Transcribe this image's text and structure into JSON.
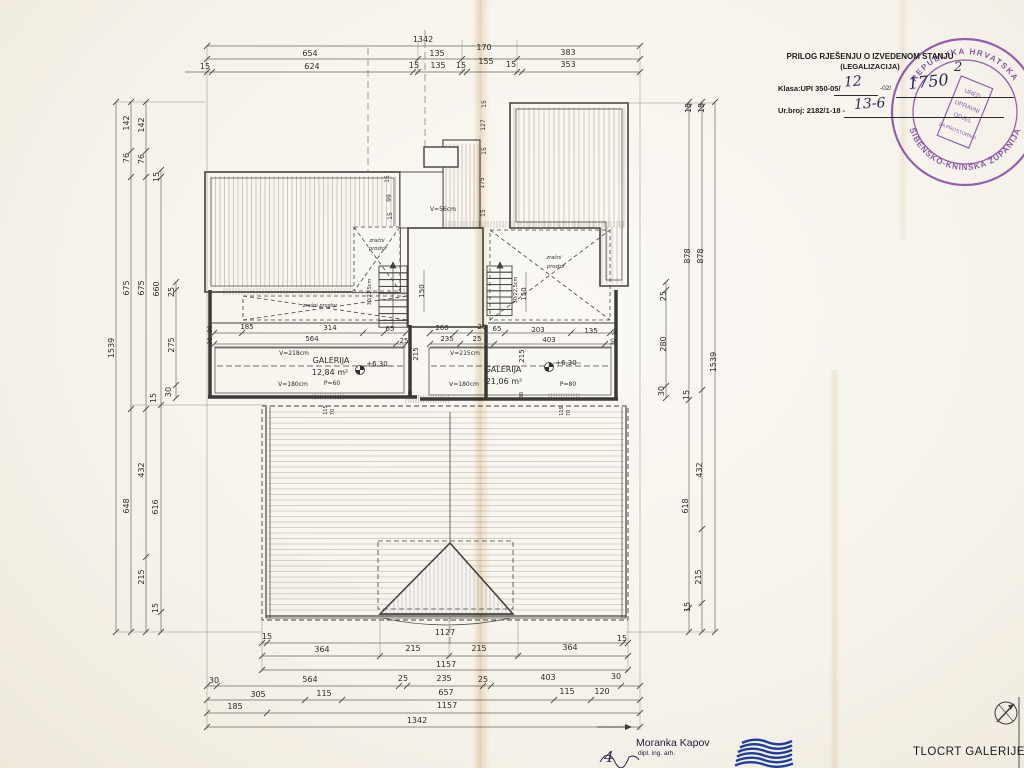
{
  "legalization_note": {
    "title": "PRILOG RJEŠENJU O IZVEDENOM STANJU",
    "subtitle": "(LEGALIZACIJA)",
    "klasa_label": "Klasa:UPI 350-05/",
    "klasa_value1": "12",
    "klasa_suffix": "-02/",
    "klasa_value2": "1750",
    "urbroj_label": "Ur.broj: 2182/1-18 -",
    "urbroj_value": "13-6",
    "page_number": "2"
  },
  "seal": {
    "ring_top": "REPUBLIKA HRVATSKA",
    "ring_bottom": "ŠIBENSKO-KNINSKA ŽUPANIJA",
    "inner_line1": "URED",
    "inner_line2": "UPRAVNI",
    "inner_line3": "ODJEL",
    "inner_line4": "ZA PROSTORNO",
    "color": "#7d3f9e"
  },
  "footer": {
    "author_name": "Moranka Kapov",
    "author_title": "dipl. ing. arh.",
    "sheet_number": "4",
    "drawing_title": "TLOCRT GALERIJE"
  },
  "plan": {
    "rooms": [
      {
        "name": "GALERIJA",
        "area": "12,84 m²",
        "level": "+6,30",
        "height_top": "V=218cm",
        "height_bottom": "V=180cm",
        "parapet": "P=60"
      },
      {
        "name": "GALERIJA",
        "area": "21,06 m²",
        "level": "+6,30",
        "height_top": "V=215cm",
        "height_bottom": "V=180cm",
        "parapet": "P=80"
      }
    ],
    "labels": [
      {
        "t": "1342",
        "x": 423,
        "y": 42
      },
      {
        "t": "654",
        "x": 310,
        "y": 56
      },
      {
        "t": "135",
        "x": 437,
        "y": 56
      },
      {
        "t": "170",
        "x": 484,
        "y": 50
      },
      {
        "t": "383",
        "x": 568,
        "y": 55
      },
      {
        "t": "15",
        "x": 205,
        "y": 69
      },
      {
        "t": "624",
        "x": 312,
        "y": 69
      },
      {
        "t": "15",
        "x": 414,
        "y": 68
      },
      {
        "t": "135",
        "x": 438,
        "y": 68
      },
      {
        "t": "15",
        "x": 461,
        "y": 68
      },
      {
        "t": "155",
        "x": 486,
        "y": 64
      },
      {
        "t": "15",
        "x": 511,
        "y": 67
      },
      {
        "t": "353",
        "x": 568,
        "y": 67
      },
      {
        "t": "1539",
        "x": 114,
        "y": 348,
        "r": -90
      },
      {
        "t": "142",
        "x": 129,
        "y": 123,
        "r": -90
      },
      {
        "t": "142",
        "x": 144,
        "y": 125,
        "r": -90
      },
      {
        "t": "76",
        "x": 129,
        "y": 158,
        "r": -90
      },
      {
        "t": "76",
        "x": 144,
        "y": 159,
        "r": -90
      },
      {
        "t": "15",
        "x": 159,
        "y": 177,
        "r": -90
      },
      {
        "t": "675",
        "x": 129,
        "y": 288,
        "r": -90
      },
      {
        "t": "675",
        "x": 144,
        "y": 288,
        "r": -90
      },
      {
        "t": "660",
        "x": 159,
        "y": 289,
        "r": -90
      },
      {
        "t": "25",
        "x": 174,
        "y": 292,
        "r": -90
      },
      {
        "t": "275",
        "x": 174,
        "y": 345,
        "r": -90
      },
      {
        "t": "30",
        "x": 171,
        "y": 392,
        "r": -90
      },
      {
        "t": "15",
        "x": 156,
        "y": 398,
        "r": -90
      },
      {
        "t": "648",
        "x": 129,
        "y": 506,
        "r": -90
      },
      {
        "t": "432",
        "x": 144,
        "y": 470,
        "r": -90
      },
      {
        "t": "616",
        "x": 158,
        "y": 507,
        "r": -90
      },
      {
        "t": "215",
        "x": 144,
        "y": 577,
        "r": -90
      },
      {
        "t": "15",
        "x": 158,
        "y": 608,
        "r": -90
      },
      {
        "t": "1539",
        "x": 716,
        "y": 362,
        "r": -90
      },
      {
        "t": "15",
        "x": 691,
        "y": 108,
        "r": -90
      },
      {
        "t": "15",
        "x": 704,
        "y": 108,
        "r": -90
      },
      {
        "t": "878",
        "x": 690,
        "y": 256,
        "r": -90
      },
      {
        "t": "878",
        "x": 703,
        "y": 256,
        "r": -90
      },
      {
        "t": "25",
        "x": 666,
        "y": 296,
        "r": -90
      },
      {
        "t": "280",
        "x": 666,
        "y": 344,
        "r": -90
      },
      {
        "t": "30",
        "x": 664,
        "y": 391,
        "r": -90
      },
      {
        "t": "15",
        "x": 689,
        "y": 395,
        "r": -90
      },
      {
        "t": "618",
        "x": 688,
        "y": 506,
        "r": -90
      },
      {
        "t": "432",
        "x": 702,
        "y": 470,
        "r": -90
      },
      {
        "t": "215",
        "x": 701,
        "y": 577,
        "r": -90
      },
      {
        "t": "15",
        "x": 690,
        "y": 607,
        "r": -90
      },
      {
        "t": "15",
        "x": 267,
        "y": 639
      },
      {
        "t": "1127",
        "x": 445,
        "y": 635
      },
      {
        "t": "15",
        "x": 622,
        "y": 641
      },
      {
        "t": "364",
        "x": 322,
        "y": 652
      },
      {
        "t": "215",
        "x": 413,
        "y": 651
      },
      {
        "t": "215",
        "x": 479,
        "y": 651
      },
      {
        "t": "364",
        "x": 570,
        "y": 650
      },
      {
        "t": "1157",
        "x": 446,
        "y": 667
      },
      {
        "t": "30",
        "x": 214,
        "y": 683
      },
      {
        "t": "564",
        "x": 310,
        "y": 682
      },
      {
        "t": "25",
        "x": 403,
        "y": 681
      },
      {
        "t": "235",
        "x": 444,
        "y": 681
      },
      {
        "t": "25",
        "x": 483,
        "y": 682
      },
      {
        "t": "403",
        "x": 548,
        "y": 680
      },
      {
        "t": "30",
        "x": 616,
        "y": 679
      },
      {
        "t": "305",
        "x": 258,
        "y": 697
      },
      {
        "t": "115",
        "x": 324,
        "y": 696
      },
      {
        "t": "657",
        "x": 446,
        "y": 695
      },
      {
        "t": "115",
        "x": 567,
        "y": 694
      },
      {
        "t": "120",
        "x": 602,
        "y": 694
      },
      {
        "t": "185",
        "x": 235,
        "y": 709
      },
      {
        "t": "1157",
        "x": 447,
        "y": 708
      },
      {
        "t": "1342",
        "x": 417,
        "y": 723
      },
      {
        "t": "30",
        "x": 212,
        "y": 329,
        "r": -90,
        "s": 6
      },
      {
        "t": "185",
        "x": 247,
        "y": 329,
        "s": 7
      },
      {
        "t": "314",
        "x": 330,
        "y": 330,
        "s": 7
      },
      {
        "t": "65",
        "x": 390,
        "y": 331,
        "s": 7
      },
      {
        "t": "30",
        "x": 212,
        "y": 341,
        "r": -90,
        "s": 6
      },
      {
        "t": "564",
        "x": 312,
        "y": 341,
        "s": 7
      },
      {
        "t": "25",
        "x": 404,
        "y": 343,
        "s": 7
      },
      {
        "t": "260",
        "x": 442,
        "y": 330,
        "s": 7
      },
      {
        "t": "25",
        "x": 482,
        "y": 329,
        "s": 7
      },
      {
        "t": "65",
        "x": 497,
        "y": 331,
        "s": 7
      },
      {
        "t": "203",
        "x": 538,
        "y": 332,
        "s": 7
      },
      {
        "t": "135",
        "x": 591,
        "y": 333,
        "s": 7
      },
      {
        "t": "30",
        "x": 617,
        "y": 332,
        "r": -90,
        "s": 6
      },
      {
        "t": "235",
        "x": 447,
        "y": 341,
        "s": 7
      },
      {
        "t": "25",
        "x": 477,
        "y": 341,
        "s": 7
      },
      {
        "t": "403",
        "x": 549,
        "y": 342,
        "s": 7
      },
      {
        "t": "30",
        "x": 615,
        "y": 342,
        "r": -90,
        "s": 6
      },
      {
        "t": "215",
        "x": 418,
        "y": 354,
        "r": -90,
        "s": 7
      },
      {
        "t": "215",
        "x": 524,
        "y": 356,
        "r": -90,
        "s": 7
      },
      {
        "t": "150",
        "x": 424,
        "y": 291,
        "r": -90,
        "s": 7
      },
      {
        "t": "150",
        "x": 526,
        "y": 294,
        "r": -90,
        "s": 7
      },
      {
        "t": "30/22,5cm",
        "x": 371,
        "y": 292,
        "r": -90,
        "s": 5
      },
      {
        "t": "30/22,5cm",
        "x": 517,
        "y": 290,
        "r": -90,
        "s": 5
      },
      {
        "t": "V=56cm",
        "x": 443,
        "y": 211,
        "s": 6,
        "n": "void-height-label"
      },
      {
        "t": "15",
        "x": 389,
        "y": 179,
        "r": -90,
        "s": 6
      },
      {
        "t": "99",
        "x": 391,
        "y": 198,
        "r": -90,
        "s": 6
      },
      {
        "t": "15",
        "x": 392,
        "y": 216,
        "r": -90,
        "s": 6
      },
      {
        "t": "15",
        "x": 486,
        "y": 104,
        "r": -90,
        "s": 6
      },
      {
        "t": "127",
        "x": 485,
        "y": 125,
        "r": -90,
        "s": 6
      },
      {
        "t": "15",
        "x": 486,
        "y": 151,
        "r": -90,
        "s": 6
      },
      {
        "t": "175",
        "x": 484,
        "y": 183,
        "r": -90,
        "s": 6
      },
      {
        "t": "15",
        "x": 485,
        "y": 213,
        "r": -90,
        "s": 6
      },
      {
        "t": "115",
        "x": 327,
        "y": 410,
        "r": -90,
        "s": 5
      },
      {
        "t": "70",
        "x": 334,
        "y": 412,
        "r": -90,
        "s": 5
      },
      {
        "t": "115",
        "x": 563,
        "y": 411,
        "r": -90,
        "s": 5
      },
      {
        "t": "70",
        "x": 570,
        "y": 413,
        "r": -90,
        "s": 5
      },
      {
        "t": "30",
        "x": 412,
        "y": 394,
        "r": -90,
        "s": 5
      },
      {
        "t": "30",
        "x": 523,
        "y": 395,
        "r": -90,
        "s": 5
      },
      {
        "t": "V=218cm",
        "x": 294,
        "y": 355,
        "s": 6,
        "n": "room-height-label"
      },
      {
        "t": "GALERIJA",
        "x": 331,
        "y": 363,
        "s": 8,
        "n": "room-name-label"
      },
      {
        "t": "12,84 m²",
        "x": 330,
        "y": 375,
        "s": 8,
        "n": "room-area-label"
      },
      {
        "t": "+6,30",
        "x": 377,
        "y": 366,
        "s": 7,
        "n": "level-label"
      },
      {
        "t": "V=180cm",
        "x": 293,
        "y": 386,
        "s": 6,
        "n": "room-height-label"
      },
      {
        "t": "P=60",
        "x": 332,
        "y": 385,
        "s": 6,
        "n": "parapet-label"
      },
      {
        "t": "V=215cm",
        "x": 465,
        "y": 355,
        "s": 6,
        "n": "room-height-label"
      },
      {
        "t": "GALERIJA",
        "x": 503,
        "y": 372,
        "s": 8,
        "n": "room-name-label"
      },
      {
        "t": "21,06 m²",
        "x": 504,
        "y": 384,
        "s": 8,
        "n": "room-area-label"
      },
      {
        "t": "+6,30",
        "x": 566,
        "y": 365,
        "s": 7,
        "n": "level-label"
      },
      {
        "t": "V=180cm",
        "x": 464,
        "y": 386,
        "s": 6,
        "n": "room-height-label"
      },
      {
        "t": "P=80",
        "x": 568,
        "y": 386,
        "s": 6,
        "n": "parapet-label"
      },
      {
        "t": "zračni",
        "x": 377,
        "y": 242,
        "i": 1,
        "s": 5,
        "n": "air-space-label"
      },
      {
        "t": "prostor",
        "x": 378,
        "y": 250,
        "i": 1,
        "s": 5,
        "n": "air-space-label"
      },
      {
        "t": "zračni",
        "x": 554,
        "y": 259,
        "i": 1,
        "s": 5,
        "n": "air-space-label"
      },
      {
        "t": "prostor",
        "x": 556,
        "y": 268,
        "i": 1,
        "s": 5,
        "n": "air-space-label"
      },
      {
        "t": "zračni prostor",
        "x": 320,
        "y": 307,
        "i": 1,
        "s": 5,
        "n": "air-space-label"
      }
    ]
  }
}
